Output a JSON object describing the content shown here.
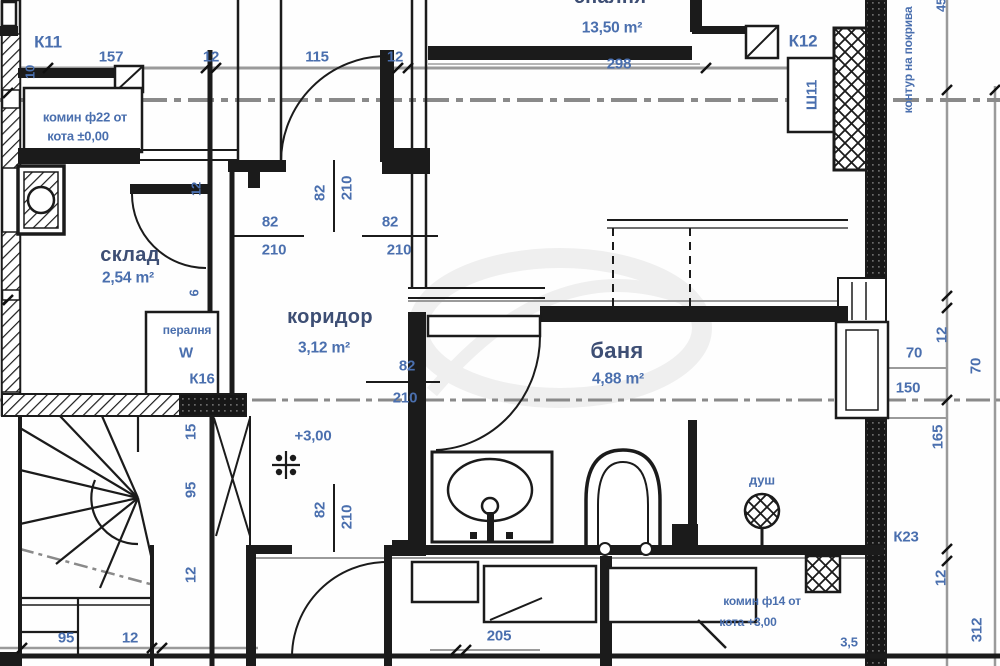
{
  "drawing": {
    "rooms": {
      "bedroom": {
        "name": "спалня",
        "area": "13,50 m²"
      },
      "storage": {
        "name": "склад",
        "area": "2,54 m²"
      },
      "corridor": {
        "name": "коридор",
        "area": "3,12 m²"
      },
      "bathroom": {
        "name": "баня",
        "area": "4,88 m²"
      }
    },
    "annotations": {
      "k11": "К11",
      "k12": "К12",
      "k16": "К16",
      "k23": "К23",
      "sh11": "Ш11",
      "washer": "пералня",
      "washer_symbol": "W",
      "shower": "душ",
      "level_mark": "+3,00",
      "chimney22_line1": "комин ф22 от",
      "chimney22_line2": "кота ±0,00",
      "chimney14_line1": "комин ф14 от",
      "chimney14_line2": "кота +3,00",
      "roof_note": "контур на покрива"
    },
    "dims": {
      "d157": "157",
      "d12": "12",
      "d115": "115",
      "d298": "298",
      "d45": "45",
      "d10": "10",
      "d6": "6",
      "d70": "70",
      "d150": "150",
      "d165": "165",
      "d312": "312",
      "d35": "3,5",
      "d15": "15",
      "d95": "95",
      "d205": "205",
      "door_w": "82",
      "door_h": "210"
    },
    "colors": {
      "line": "#1b1b1b",
      "dim_text": "#4a6fae",
      "room_text": "#3d4e74",
      "centerline": "#8a8a8a"
    }
  }
}
